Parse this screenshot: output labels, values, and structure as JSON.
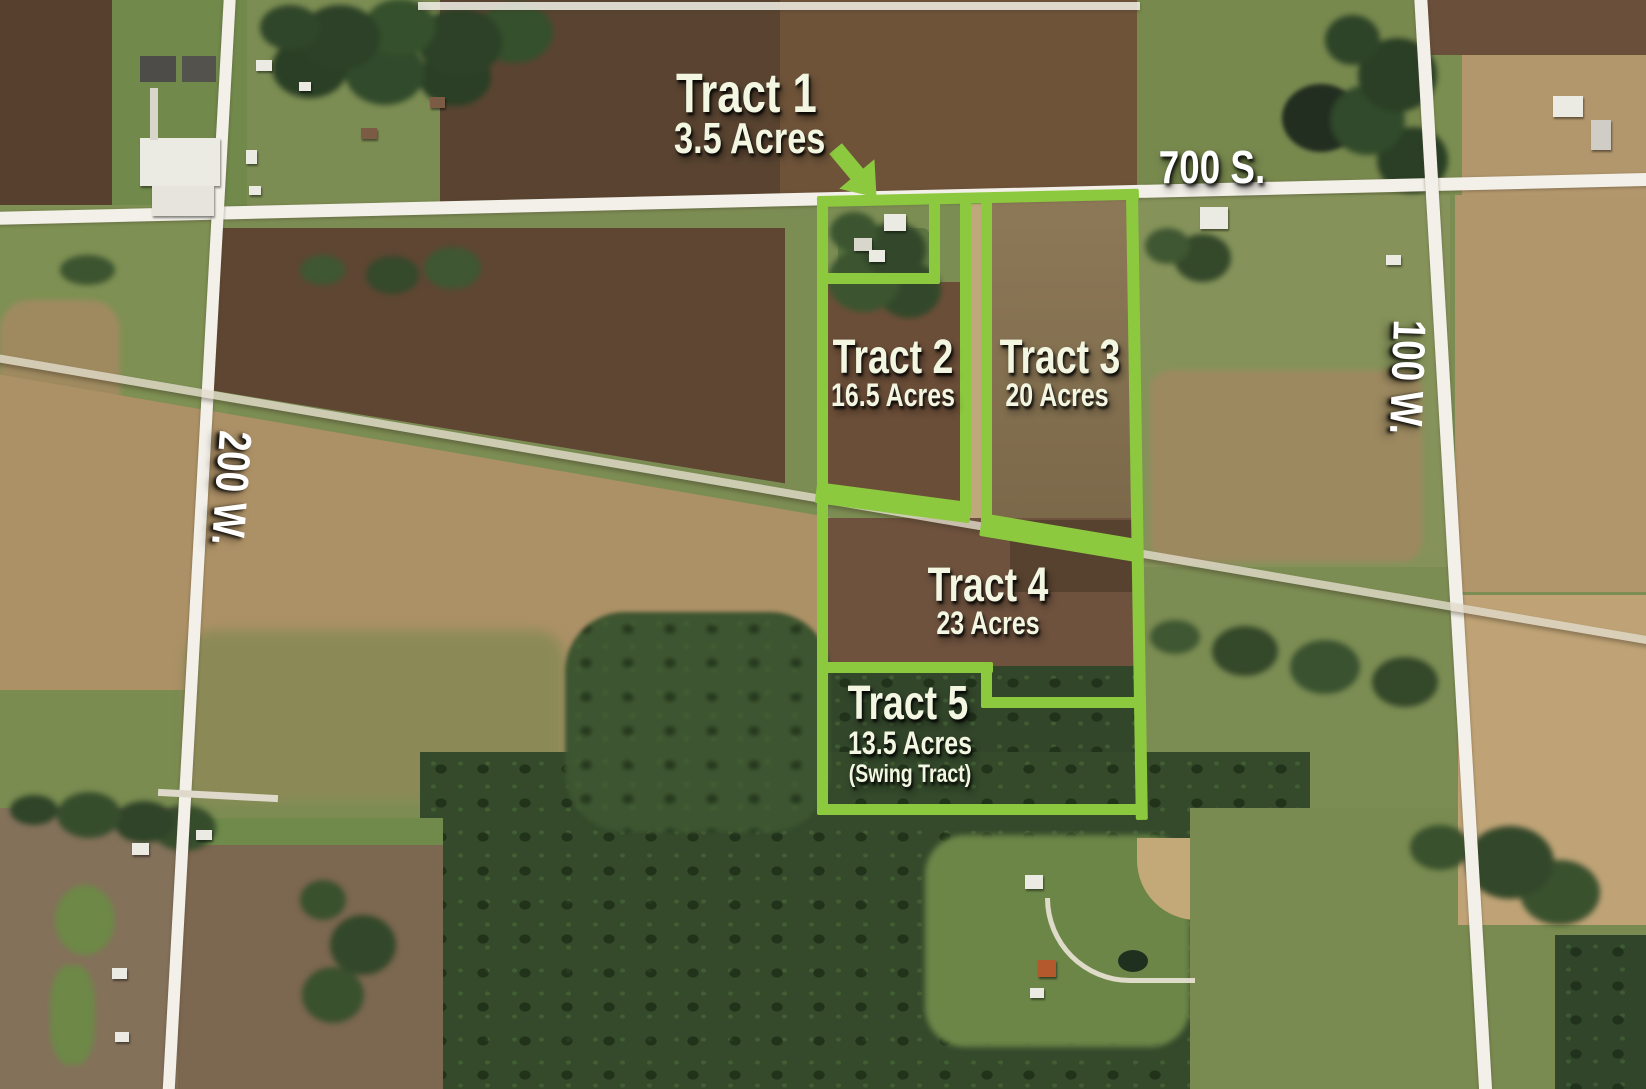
{
  "map": {
    "tracts": [
      {
        "name": "Tract 1",
        "acres": "3.5 Acres"
      },
      {
        "name": "Tract 2",
        "acres": "16.5 Acres"
      },
      {
        "name": "Tract 3",
        "acres": "20 Acres"
      },
      {
        "name": "Tract 4",
        "acres": "23 Acres"
      },
      {
        "name": "Tract 5",
        "acres": "13.5 Acres",
        "note": "(Swing Tract)"
      }
    ],
    "roads": [
      {
        "label": "700 S."
      },
      {
        "label": "100 W."
      },
      {
        "label": "200 W."
      }
    ],
    "colors": {
      "tract_boundary": "#8cc93e",
      "tract_label_text": "#f3f7e2",
      "road_label_text": "#ffffff"
    }
  }
}
